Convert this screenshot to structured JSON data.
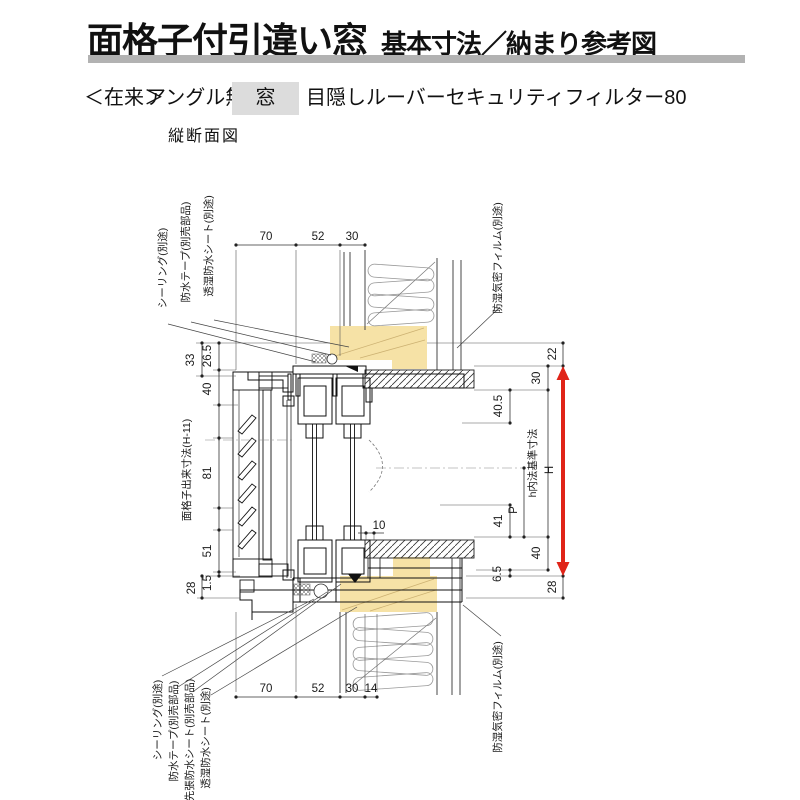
{
  "header": {
    "title_main": "面格子付引違い窓",
    "title_sub": "基本寸法／納まり参考図",
    "construction": "＜在来＞",
    "angle": "アングル無",
    "window_tag": "窓",
    "product": "目隠しルーバーセキュリティフィルター80",
    "section_label": "縦断面図"
  },
  "dims": {
    "top": {
      "d70": "70",
      "d52": "52",
      "d30": "30"
    },
    "bottom": {
      "d70": "70",
      "d52": "52",
      "d30": "30",
      "d14": "14"
    },
    "left": {
      "d33": "33",
      "d265": "26.5",
      "d40": "40",
      "d81": "81",
      "d51": "51",
      "d15": "1.5",
      "d28": "28",
      "lattice": "面格子出来寸法(H-11)"
    },
    "right": {
      "d22": "22",
      "d30": "30",
      "d405": "40.5",
      "d41": "41",
      "p": "P",
      "d40": "40",
      "d65": "6.5",
      "d28": "28",
      "h": "h内法基準寸法",
      "H": "H"
    },
    "gap10": "10"
  },
  "labels": {
    "seal": "シーリング(別途)",
    "tape": "防水テープ(別売部品)",
    "sheet_toshitsu": "透湿防水シート(別途)",
    "sheet_sakibari": "先張防水シート(別売部品)",
    "film": "防湿気密フィルム(別途)"
  },
  "colors": {
    "wood": "#f6e2a6",
    "arrow_red": "#e02418",
    "title_bar": "#b2b2b2",
    "tag_bg": "#dcdcdc"
  }
}
